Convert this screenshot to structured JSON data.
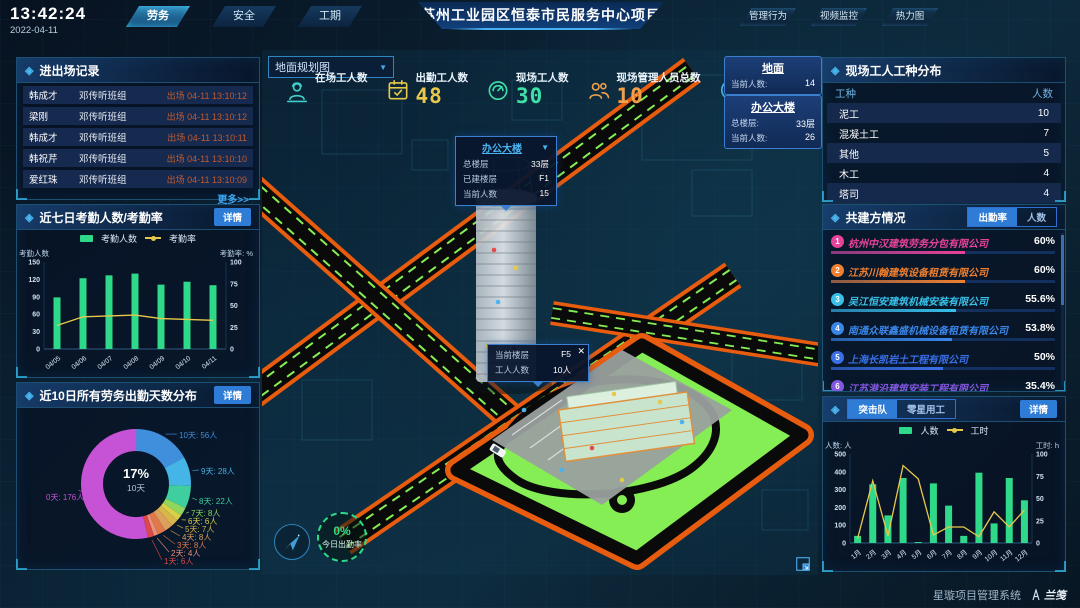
{
  "header": {
    "time": "13:42:24",
    "date": "2022-04-11",
    "nav_left": [
      {
        "label": "劳务",
        "active": true
      },
      {
        "label": "安全",
        "active": false
      },
      {
        "label": "工期",
        "active": false
      }
    ],
    "title": "苏州工业园区恒泰市民服务中心项目",
    "nav_right": [
      {
        "label": "管理行为"
      },
      {
        "label": "视频监控"
      },
      {
        "label": "热力图"
      }
    ]
  },
  "entry_exit_panel": {
    "title": "进出场记录",
    "rows": [
      {
        "name": "韩成才",
        "group": "邓传听班组",
        "event": "出场 04-11 13:10:12"
      },
      {
        "name": "梁刚",
        "group": "邓传听班组",
        "event": "出场 04-11 13:10:12"
      },
      {
        "name": "韩成才",
        "group": "邓传听班组",
        "event": "出场 04-11 13:10:11"
      },
      {
        "name": "韩祝芹",
        "group": "邓传听班组",
        "event": "出场 04-11 13:10:10"
      },
      {
        "name": "爱红珠",
        "group": "邓传听班组",
        "event": "出场 04-11 13:10:09"
      }
    ],
    "more_label": "更多>>"
  },
  "attendance_panel": {
    "title": "近七日考勤人数/考勤率",
    "detail_label": "详情",
    "chart_data": {
      "type": "bar+line",
      "categories": [
        "04/05",
        "04/06",
        "04/07",
        "04/08",
        "04/09",
        "04/10",
        "04/11"
      ],
      "series": [
        {
          "name": "考勤人数",
          "type": "bar",
          "color": "#2fd98a",
          "axis": "left",
          "values": [
            89,
            122,
            127,
            130,
            111,
            116,
            110
          ]
        },
        {
          "name": "考勤率",
          "type": "line",
          "color": "#e8c84a",
          "axis": "right",
          "values": [
            27,
            37,
            38,
            39,
            35,
            34,
            33
          ]
        }
      ],
      "left_axis": {
        "label": "考勤人数",
        "max": 150,
        "ticks": [
          0,
          30,
          60,
          90,
          120,
          150
        ]
      },
      "right_axis": {
        "label": "考勤率: %",
        "max": 100,
        "ticks": [
          0,
          25,
          50,
          75,
          100
        ]
      }
    }
  },
  "distribution_panel": {
    "title": "近10日所有劳务出勤天数分布",
    "detail_label": "详情",
    "center": {
      "pct": "17%",
      "label": "10天"
    },
    "chart_data": {
      "type": "pie",
      "slices": [
        {
          "label": "10天",
          "value": 56,
          "unit": "人",
          "color": "#3f8fdd"
        },
        {
          "label": "9天",
          "value": 28,
          "unit": "人",
          "color": "#45b4e6"
        },
        {
          "label": "8天",
          "value": 22,
          "unit": "人",
          "color": "#3fcf9f"
        },
        {
          "label": "7天",
          "value": 8,
          "unit": "人",
          "color": "#8ed65c"
        },
        {
          "label": "6天",
          "value": 6,
          "unit": "人",
          "color": "#d7d049"
        },
        {
          "label": "5天",
          "value": 7,
          "unit": "人",
          "color": "#d9b64a"
        },
        {
          "label": "4天",
          "value": 8,
          "unit": "人",
          "color": "#dba05c"
        },
        {
          "label": "3天",
          "value": 8,
          "unit": "人",
          "color": "#e0784a"
        },
        {
          "label": "2天",
          "value": 4,
          "unit": "人",
          "color": "#e8927c"
        },
        {
          "label": "1天",
          "value": 6,
          "unit": "人",
          "color": "#e04848"
        },
        {
          "label": "0天",
          "value": 176,
          "unit": "人",
          "color": "#c653d6"
        }
      ]
    }
  },
  "scene": {
    "view_select": {
      "value": "地面规划图"
    },
    "stats": [
      {
        "label": "在场工人数",
        "value": "",
        "icon": "worker-icon",
        "color": "#3fd0c9"
      },
      {
        "label": "出勤工人数",
        "value": "48",
        "icon": "calendar-check-icon",
        "color": "#e8c84a"
      },
      {
        "label": "现场工人数",
        "value": "30",
        "icon": "gauge-icon",
        "color": "#3fe0a8"
      },
      {
        "label": "现场管理人员总数",
        "value": "10",
        "icon": "people-icon",
        "color": "#f0a04a"
      },
      {
        "label": "异常出勤数",
        "value": "0",
        "icon": "pulse-icon",
        "color": "#4ab3f0"
      }
    ],
    "info_cards": [
      {
        "title": "地面",
        "rows": [
          {
            "label": "当前人数:",
            "value": "14"
          }
        ]
      },
      {
        "title": "办公大楼",
        "rows": [
          {
            "label": "总楼层:",
            "value": "33层"
          },
          {
            "label": "当前人数:",
            "value": "26"
          }
        ]
      }
    ],
    "building_tooltip": {
      "title": "办公大楼",
      "rows": [
        {
          "label": "总楼层",
          "value": "33层"
        },
        {
          "label": "已建楼层",
          "value": "F1"
        },
        {
          "label": "当前人数",
          "value": "15"
        }
      ]
    },
    "floor_tooltip": {
      "rows": [
        {
          "label": "当前楼层",
          "value": "F5"
        },
        {
          "label": "工人人数",
          "value": "10人"
        }
      ]
    },
    "attendance_badge": {
      "pct": "0%",
      "label": "今日出勤率"
    }
  },
  "worker_types_panel": {
    "title": "现场工人工种分布",
    "headers": [
      "工种",
      "人数"
    ],
    "rows": [
      [
        "泥工",
        "10"
      ],
      [
        "混凝土工",
        "7"
      ],
      [
        "其他",
        "5"
      ],
      [
        "木工",
        "4"
      ],
      [
        "塔司",
        "4"
      ]
    ]
  },
  "partners_panel": {
    "title": "共建方情况",
    "tabs": [
      {
        "label": "出勤率",
        "active": true
      },
      {
        "label": "人数",
        "active": false
      }
    ],
    "rows": [
      {
        "rank": "1",
        "name": "杭州中汉建筑劳务分包有限公司",
        "pct": "60%",
        "width": 60,
        "color": "#e8439a"
      },
      {
        "rank": "2",
        "name": "江苏川翰建筑设备租赁有限公司",
        "pct": "60%",
        "width": 60,
        "color": "#f08030"
      },
      {
        "rank": "3",
        "name": "吴江恒安建筑机械安装有限公司",
        "pct": "55.6%",
        "width": 55.6,
        "color": "#38c0e8"
      },
      {
        "rank": "4",
        "name": "南通众联鑫盛机械设备租赁有限公司",
        "pct": "53.8%",
        "width": 53.8,
        "color": "#3a86e8"
      },
      {
        "rank": "5",
        "name": "上海长凯岩土工程有限公司",
        "pct": "50%",
        "width": 50,
        "color": "#3a6fe8"
      },
      {
        "rank": "6",
        "name": "江苏港沿建筑安装工程有限公司",
        "pct": "35.4%",
        "width": 35.4,
        "color": "#8457e0"
      }
    ]
  },
  "assault_panel": {
    "detail_label": "详情",
    "tabs": [
      {
        "label": "突击队",
        "active": true
      },
      {
        "label": "零星用工",
        "active": false
      }
    ],
    "chart_data": {
      "type": "bar+line",
      "categories": [
        "1月",
        "2月",
        "3月",
        "4月",
        "5月",
        "6月",
        "7月",
        "8月",
        "9月",
        "10月",
        "11月",
        "12月"
      ],
      "series": [
        {
          "name": "人数",
          "type": "bar",
          "color": "#2fd98a",
          "axis": "left",
          "values": [
            40,
            330,
            155,
            365,
            5,
            335,
            210,
            40,
            395,
            110,
            365,
            240
          ]
        },
        {
          "name": "工时",
          "type": "line",
          "color": "#e8c84a",
          "axis": "right",
          "values": [
            5,
            70,
            8,
            87,
            72,
            9,
            18,
            18,
            7,
            35,
            18,
            37
          ]
        }
      ],
      "left_axis": {
        "label": "人数: 人",
        "max": 500,
        "ticks": [
          0,
          100,
          200,
          300,
          400,
          500
        ]
      },
      "right_axis": {
        "label": "工时: h",
        "max": 100,
        "ticks": [
          0,
          25,
          50,
          75,
          100
        ]
      }
    }
  },
  "footer": {
    "system_name": "星璇项目管理系统",
    "logo_text": "兰笺"
  }
}
